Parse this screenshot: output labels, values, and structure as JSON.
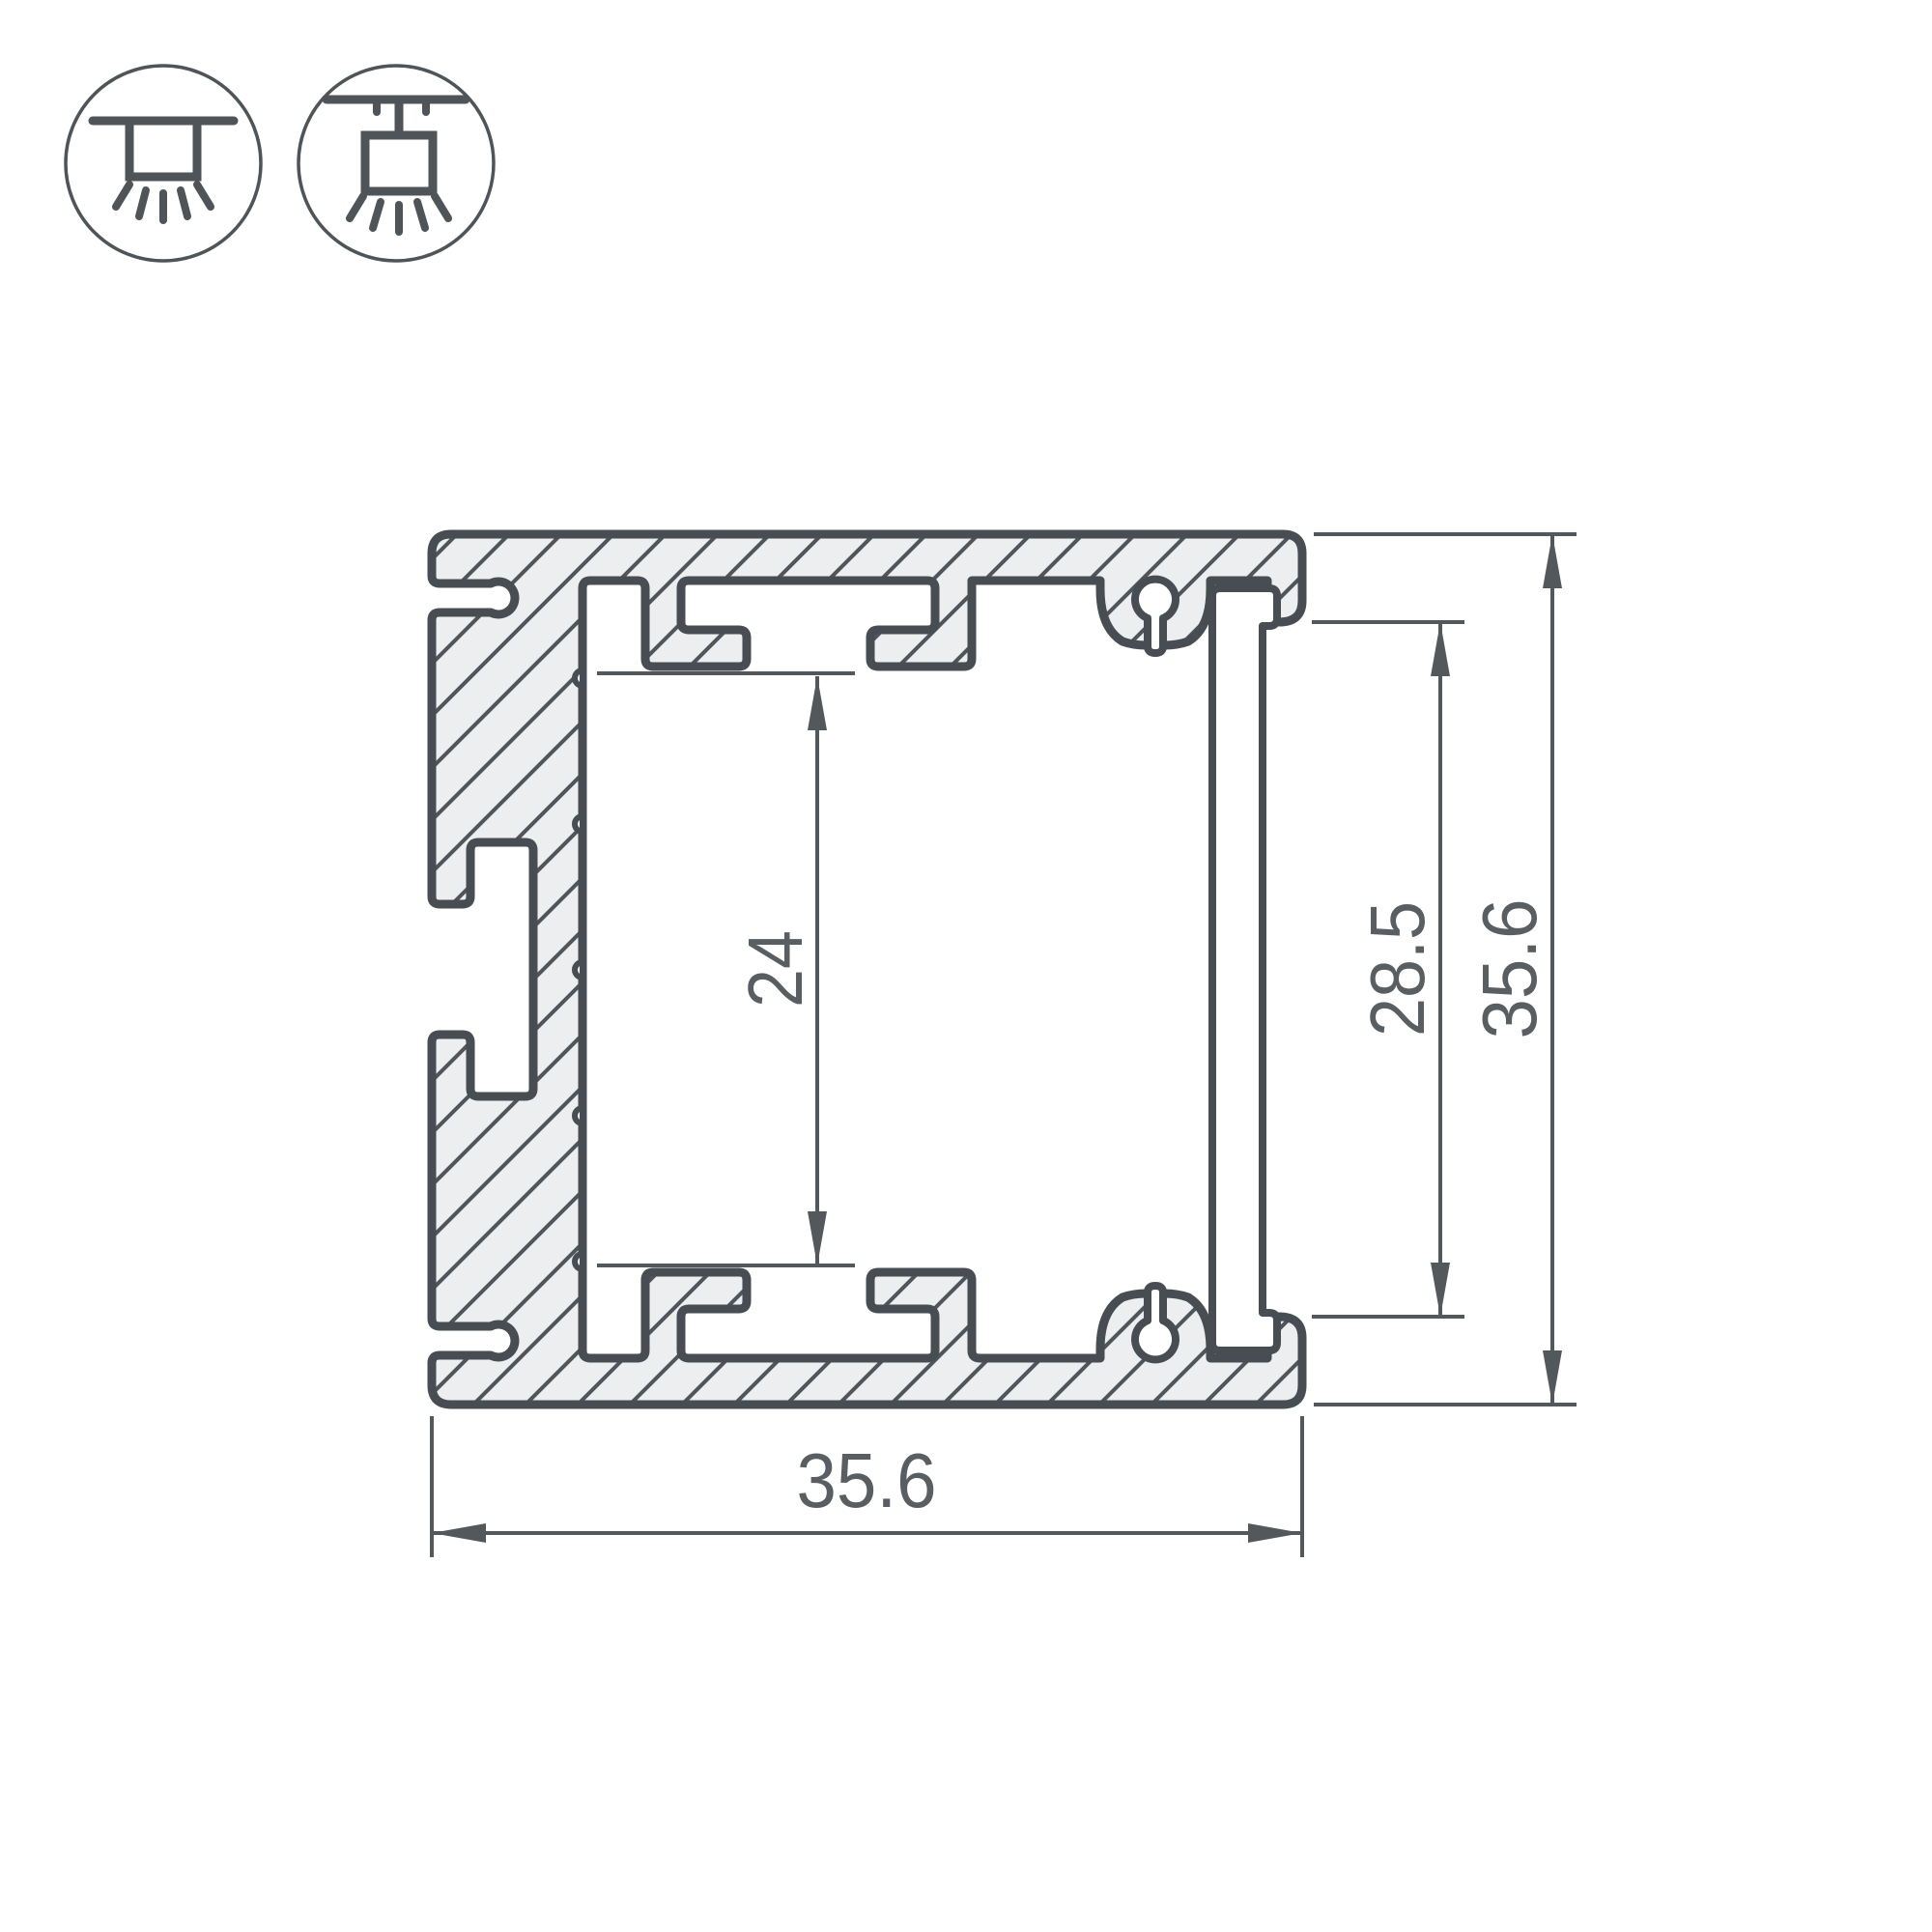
{
  "drawing": {
    "type": "technical-cross-section",
    "subject": "aluminum LED profile cross-section with mounting icons and dimensions",
    "background": "#ffffff"
  },
  "colors": {
    "outline": "#474d52",
    "hatch": "#4f555a",
    "aluminum_fill": "#edeef0",
    "dimension_lines": "#53585c",
    "dimension_text": "#595e62",
    "icon_stroke": "#4f5459"
  },
  "icons": [
    {
      "name": "surface-mount-icon",
      "meaning": "surface / recessed ceiling mount luminaire"
    },
    {
      "name": "pendant-mount-icon",
      "meaning": "suspended (pendant) mount luminaire"
    }
  ],
  "dimensions": {
    "inner_height": "24",
    "opening_height": "28.5",
    "outer_height": "35.6",
    "outer_width": "35.6"
  }
}
